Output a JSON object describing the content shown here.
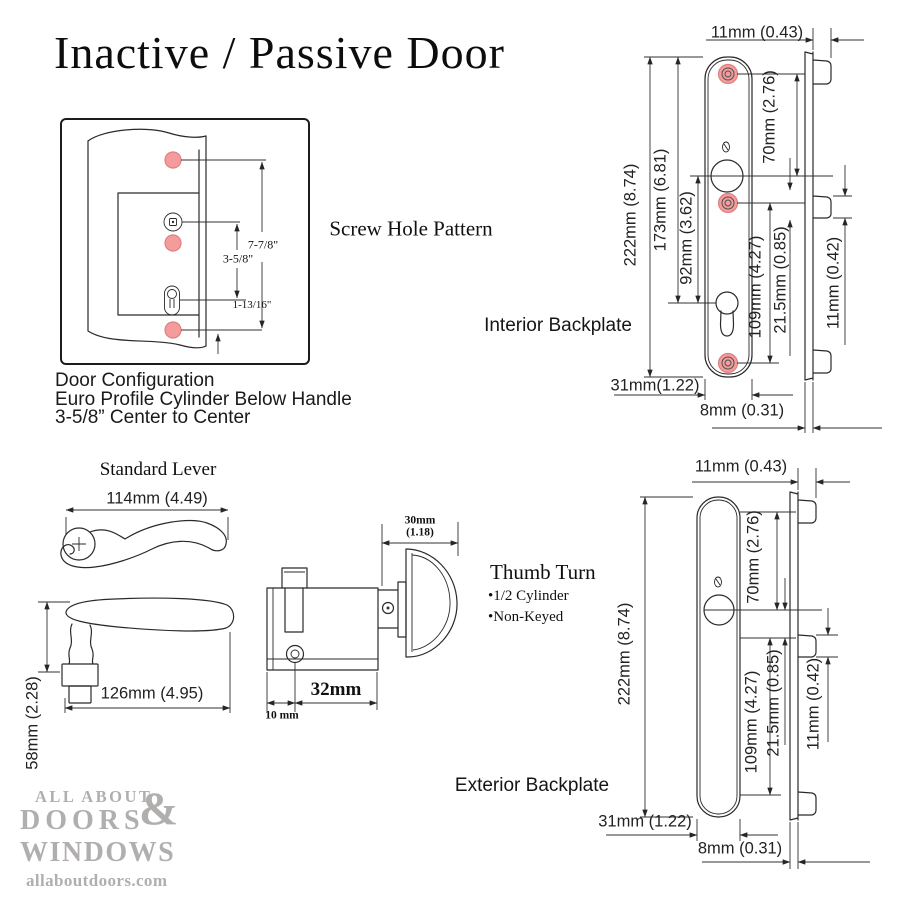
{
  "title": "Inactive / Passive Door",
  "colors": {
    "screw_hole": "#f49c9c",
    "screw_hole_edge": "#e07f7f",
    "line": "#2a2a2a",
    "logo_gray": "#b1aeae"
  },
  "screw_hole_pattern": {
    "heading": "Screw Hole Pattern",
    "dim_overall": "7-7/8\"",
    "dim_handle_to_cylinder": "3-5/8\"",
    "dim_cylinder_to_screw": "1-13/16\"",
    "caption_line1": "Door Configuration",
    "caption_line2": "Euro Profile Cylinder Below Handle",
    "caption_line3": "3-5/8” Center to Center"
  },
  "interior_backplate": {
    "heading": "Interior Backplate",
    "dim_top_width": "11mm (0.43)",
    "dim_height": "222mm (8.74)",
    "dim_top_to_cylinder": "173mm (6.81)",
    "dim_handle_to_cylinder": "92mm (3.62)",
    "dim_screw_to_handle": "70mm (2.76)",
    "dim_screw_to_screw": "109mm (4.27)",
    "dim_lug": "21.5mm (0.85)",
    "dim_lug_depth": "11mm (0.42)",
    "dim_plate_width": "31mm(1.22)",
    "dim_plate_depth": "8mm (0.31)"
  },
  "exterior_backplate": {
    "heading": "Exterior Backplate",
    "dim_top_width": "11mm (0.43)",
    "dim_height": "222mm (8.74)",
    "dim_screw_to_handle": "70mm (2.76)",
    "dim_screw_to_screw": "109mm (4.27)",
    "dim_lug": "21.5mm (0.85)",
    "dim_lug_depth": "11mm (0.42)",
    "dim_plate_width": "31mm (1.22)",
    "dim_plate_depth": "8mm (0.31)"
  },
  "standard_lever": {
    "heading": "Standard Lever",
    "dim_length_top": "114mm (4.49)",
    "dim_length_side": "126mm (4.95)",
    "dim_height": "58mm (2.28)"
  },
  "thumb_turn": {
    "heading": "Thumb Turn",
    "bullet1": "•1/2 Cylinder",
    "bullet2": "•Non-Keyed",
    "dim_knob_line1": "30mm",
    "dim_knob_line2": "(1.18)",
    "dim_cylinder_length": "32mm",
    "dim_offset": "10 mm"
  },
  "logo": {
    "line1": "ALL ABOUT",
    "ampersand": "&",
    "line2": "DOORS",
    "line3": "WINDOWS",
    "website": "allaboutdoors.com"
  }
}
